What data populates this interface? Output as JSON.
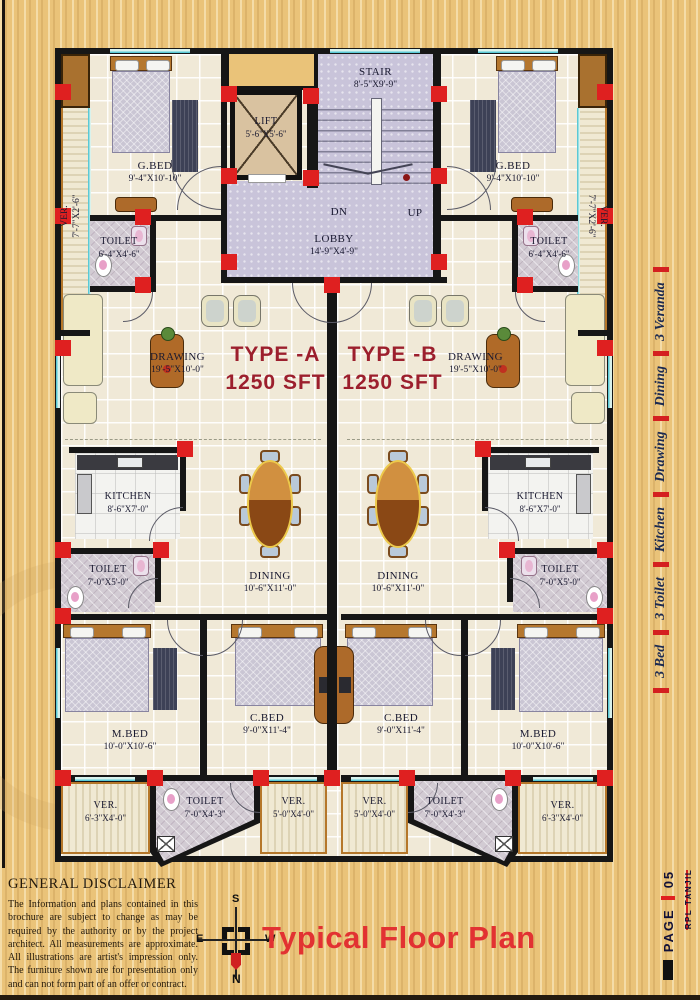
{
  "plan": {
    "core": {
      "stair": {
        "name": "STAIR",
        "dims": "8'-5\"X9'-9\""
      },
      "lift": {
        "name": "LIFT",
        "dims": "5'-6\"X5'-6\""
      },
      "lobby": {
        "name": "LOBBY",
        "dims": "14'-9\"X4'-9\""
      },
      "dn": "DN",
      "up": "UP"
    },
    "unit_a": {
      "type_name": "TYPE -A",
      "type_area": "1250 SFT",
      "ver_side": {
        "name": "VER.",
        "dims": "7'-7\"X2'-6\""
      },
      "g_bed": {
        "name": "G.BED",
        "dims": "9'-4\"X10'-10\""
      },
      "toilet_top": {
        "name": "TOILET",
        "dims": "6'-4\"X4'-6\""
      },
      "drawing": {
        "name": "DRAWING",
        "dims": "19'-5\"X10'-0\""
      },
      "kitchen": {
        "name": "KITCHEN",
        "dims": "8'-6\"X7'-0\""
      },
      "toilet_mid": {
        "name": "TOILET",
        "dims": "7'-0\"X5'-0\""
      },
      "dining": {
        "name": "DINING",
        "dims": "10'-6\"X11'-0\""
      },
      "m_bed": {
        "name": "M.BED",
        "dims": "10'-0\"X10'-6\""
      },
      "c_bed": {
        "name": "C.BED",
        "dims": "9'-0\"X11'-4\""
      },
      "ver_out": {
        "name": "VER.",
        "dims": "6'-3\"X4'-0\""
      },
      "toilet_bot": {
        "name": "TOILET",
        "dims": "7'-0\"X4'-3\""
      },
      "ver_in": {
        "name": "VER.",
        "dims": "5'-0\"X4'-0\""
      }
    },
    "unit_b": {
      "type_name": "TYPE -B",
      "type_area": "1250 SFT",
      "ver_side": {
        "name": "VER.",
        "dims": "7'-7\"X2'-6\""
      },
      "g_bed": {
        "name": "G.BED",
        "dims": "9'-4\"X10'-10\""
      },
      "toilet_top": {
        "name": "TOILET",
        "dims": "6'-4\"X4'-6\""
      },
      "drawing": {
        "name": "DRAWING",
        "dims": "19'-5\"X10'-0\""
      },
      "kitchen": {
        "name": "KITCHEN",
        "dims": "8'-6\"X7'-0\""
      },
      "toilet_mid": {
        "name": "TOILET",
        "dims": "7'-0\"X5'-0\""
      },
      "dining": {
        "name": "DINING",
        "dims": "10'-6\"X11'-0\""
      },
      "m_bed": {
        "name": "M.BED",
        "dims": "10'-0\"X10'-6\""
      },
      "c_bed": {
        "name": "C.BED",
        "dims": "9'-0\"X11'-4\""
      },
      "ver_out": {
        "name": "VER.",
        "dims": "6'-3\"X4'-0\""
      },
      "toilet_bot": {
        "name": "TOILET",
        "dims": "7'-0\"X4'-3\""
      },
      "ver_in": {
        "name": "VER.",
        "dims": "5'-0\"X4'-0\""
      }
    }
  },
  "sidebar": {
    "features": [
      "3 Bed",
      "3 Toilet",
      "Kitchen",
      "Drawing",
      "Dining",
      "3 Veranda"
    ]
  },
  "page_tab": {
    "label": "PAGE",
    "number": "05",
    "brand": "RPL TANJIL"
  },
  "disclaimer": {
    "heading": "GENERAL DISCLAIMER",
    "body": "The Information and plans contained in this brochure are subject to change as may be required by the authority or by the project architect. All measurements are approximate. All illustrations are artist's impression only. The furniture shown are for presentation only and can not form part of an offer or contract."
  },
  "footer": {
    "title": "Typical Floor Plan"
  },
  "compass": {
    "n": "N",
    "s": "S",
    "e": "E",
    "w": "W"
  }
}
